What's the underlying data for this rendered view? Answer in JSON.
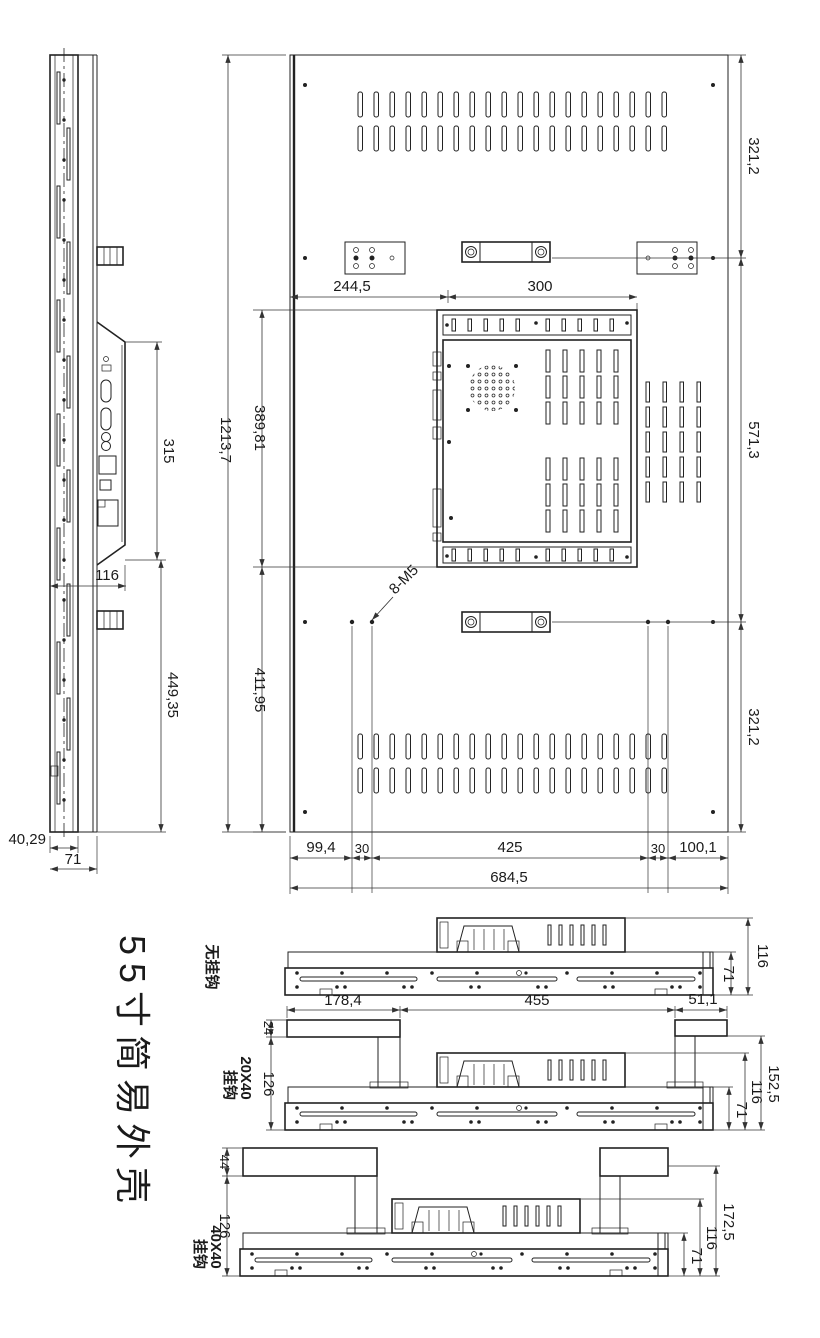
{
  "title": "55寸简易外壳",
  "colors": {
    "line": "#222222",
    "background": "#ffffff"
  },
  "side_view": {
    "dim_io_height": "315",
    "dim_io_offset": "116",
    "dim_lower_height": "449,35",
    "dim_front_depth": "40,29",
    "dim_total_depth": "71"
  },
  "back_view": {
    "dim_total_height": "1213,7",
    "dim_panel_top_height": "389,81",
    "dim_panel_bottom_height": "411,95",
    "dim_bracket_offset": "244,5",
    "dim_handle_span": "300",
    "dim_right_top": "321,2",
    "dim_right_middle": "571,3",
    "dim_right_bottom": "321,2",
    "dim_bottom_1": "99,4",
    "dim_bottom_2": "30",
    "dim_bottom_3": "425",
    "dim_bottom_4": "30",
    "dim_bottom_5": "100,1",
    "dim_total_width": "684,5",
    "thread_note": "8-M5"
  },
  "sections": {
    "no_hook": {
      "label": "无挂钩",
      "dim_height": "116",
      "dim_base_height": "71"
    },
    "hook_20x40": {
      "label_size": "20X40",
      "label_hook": "挂钩",
      "dim_hook_height": "24",
      "dim_left_span": "178,4",
      "dim_center_span": "455",
      "dim_right_span": "51,1",
      "dim_hook_drop": "126",
      "dim_total_height": "152,5",
      "dim_height": "116",
      "dim_base_height": "71"
    },
    "hook_40x40": {
      "label_size": "40X40",
      "label_hook": "挂钩",
      "dim_hook_height": "44",
      "dim_hook_drop": "126",
      "dim_total_height": "172,5",
      "dim_height": "116",
      "dim_base_height": "71"
    }
  }
}
